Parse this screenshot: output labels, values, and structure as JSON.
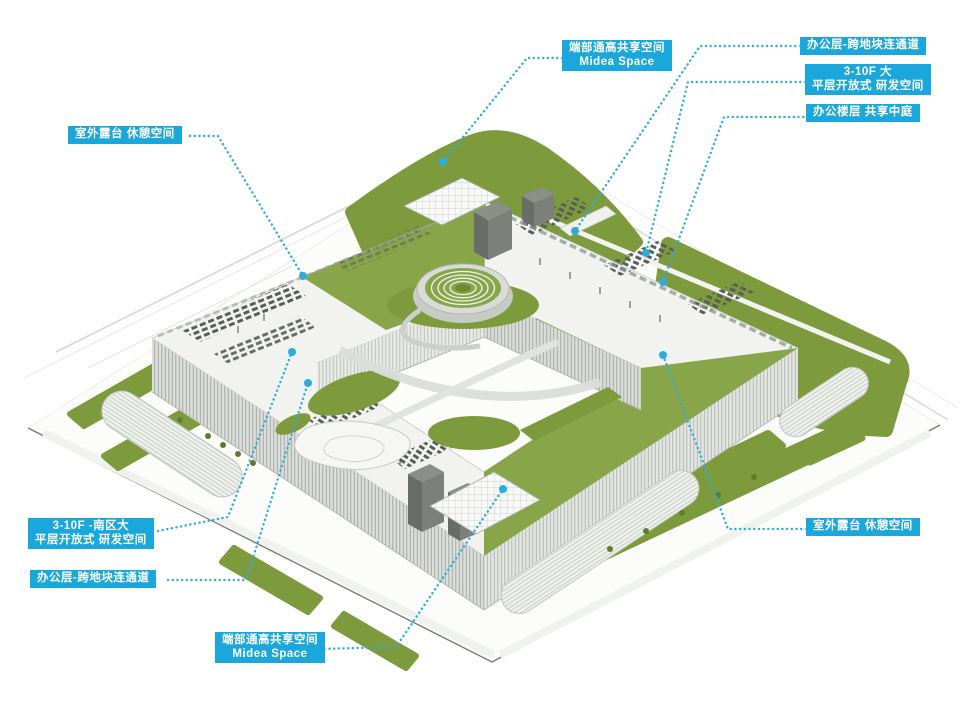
{
  "figure": {
    "description_labels_language": "zh-CN"
  },
  "colors": {
    "label_bg": "#1aa7dc",
    "label_text": "#ffffff",
    "leader": "#2facdf",
    "site_green": "#7d9a3c",
    "roof_green": "#88a54a"
  },
  "callouts": [
    {
      "id": "shared-space-top",
      "lines": [
        "端部通高共享空间",
        "Midea Space"
      ]
    },
    {
      "id": "office-corridor-top-right",
      "lines": [
        "办公层-跨地块连通道"
      ]
    },
    {
      "id": "rd-space-right",
      "lines": [
        "3-10F 大",
        "平层开放式 研发空间"
      ]
    },
    {
      "id": "atrium-right",
      "lines": [
        "办公楼层 共享中庭"
      ]
    },
    {
      "id": "terrace-left",
      "lines": [
        "室外露台 休憩空间"
      ]
    },
    {
      "id": "rd-space-bottom-left",
      "lines": [
        "3-10F -南区大",
        "平层开放式 研发空间"
      ]
    },
    {
      "id": "office-corridor-bottom-left",
      "lines": [
        "办公层-跨地块连通道"
      ]
    },
    {
      "id": "shared-space-bottom",
      "lines": [
        "端部通高共享空间",
        "Midea Space"
      ]
    },
    {
      "id": "terrace-bottom-right",
      "lines": [
        "室外露台 休憩空间"
      ]
    }
  ]
}
